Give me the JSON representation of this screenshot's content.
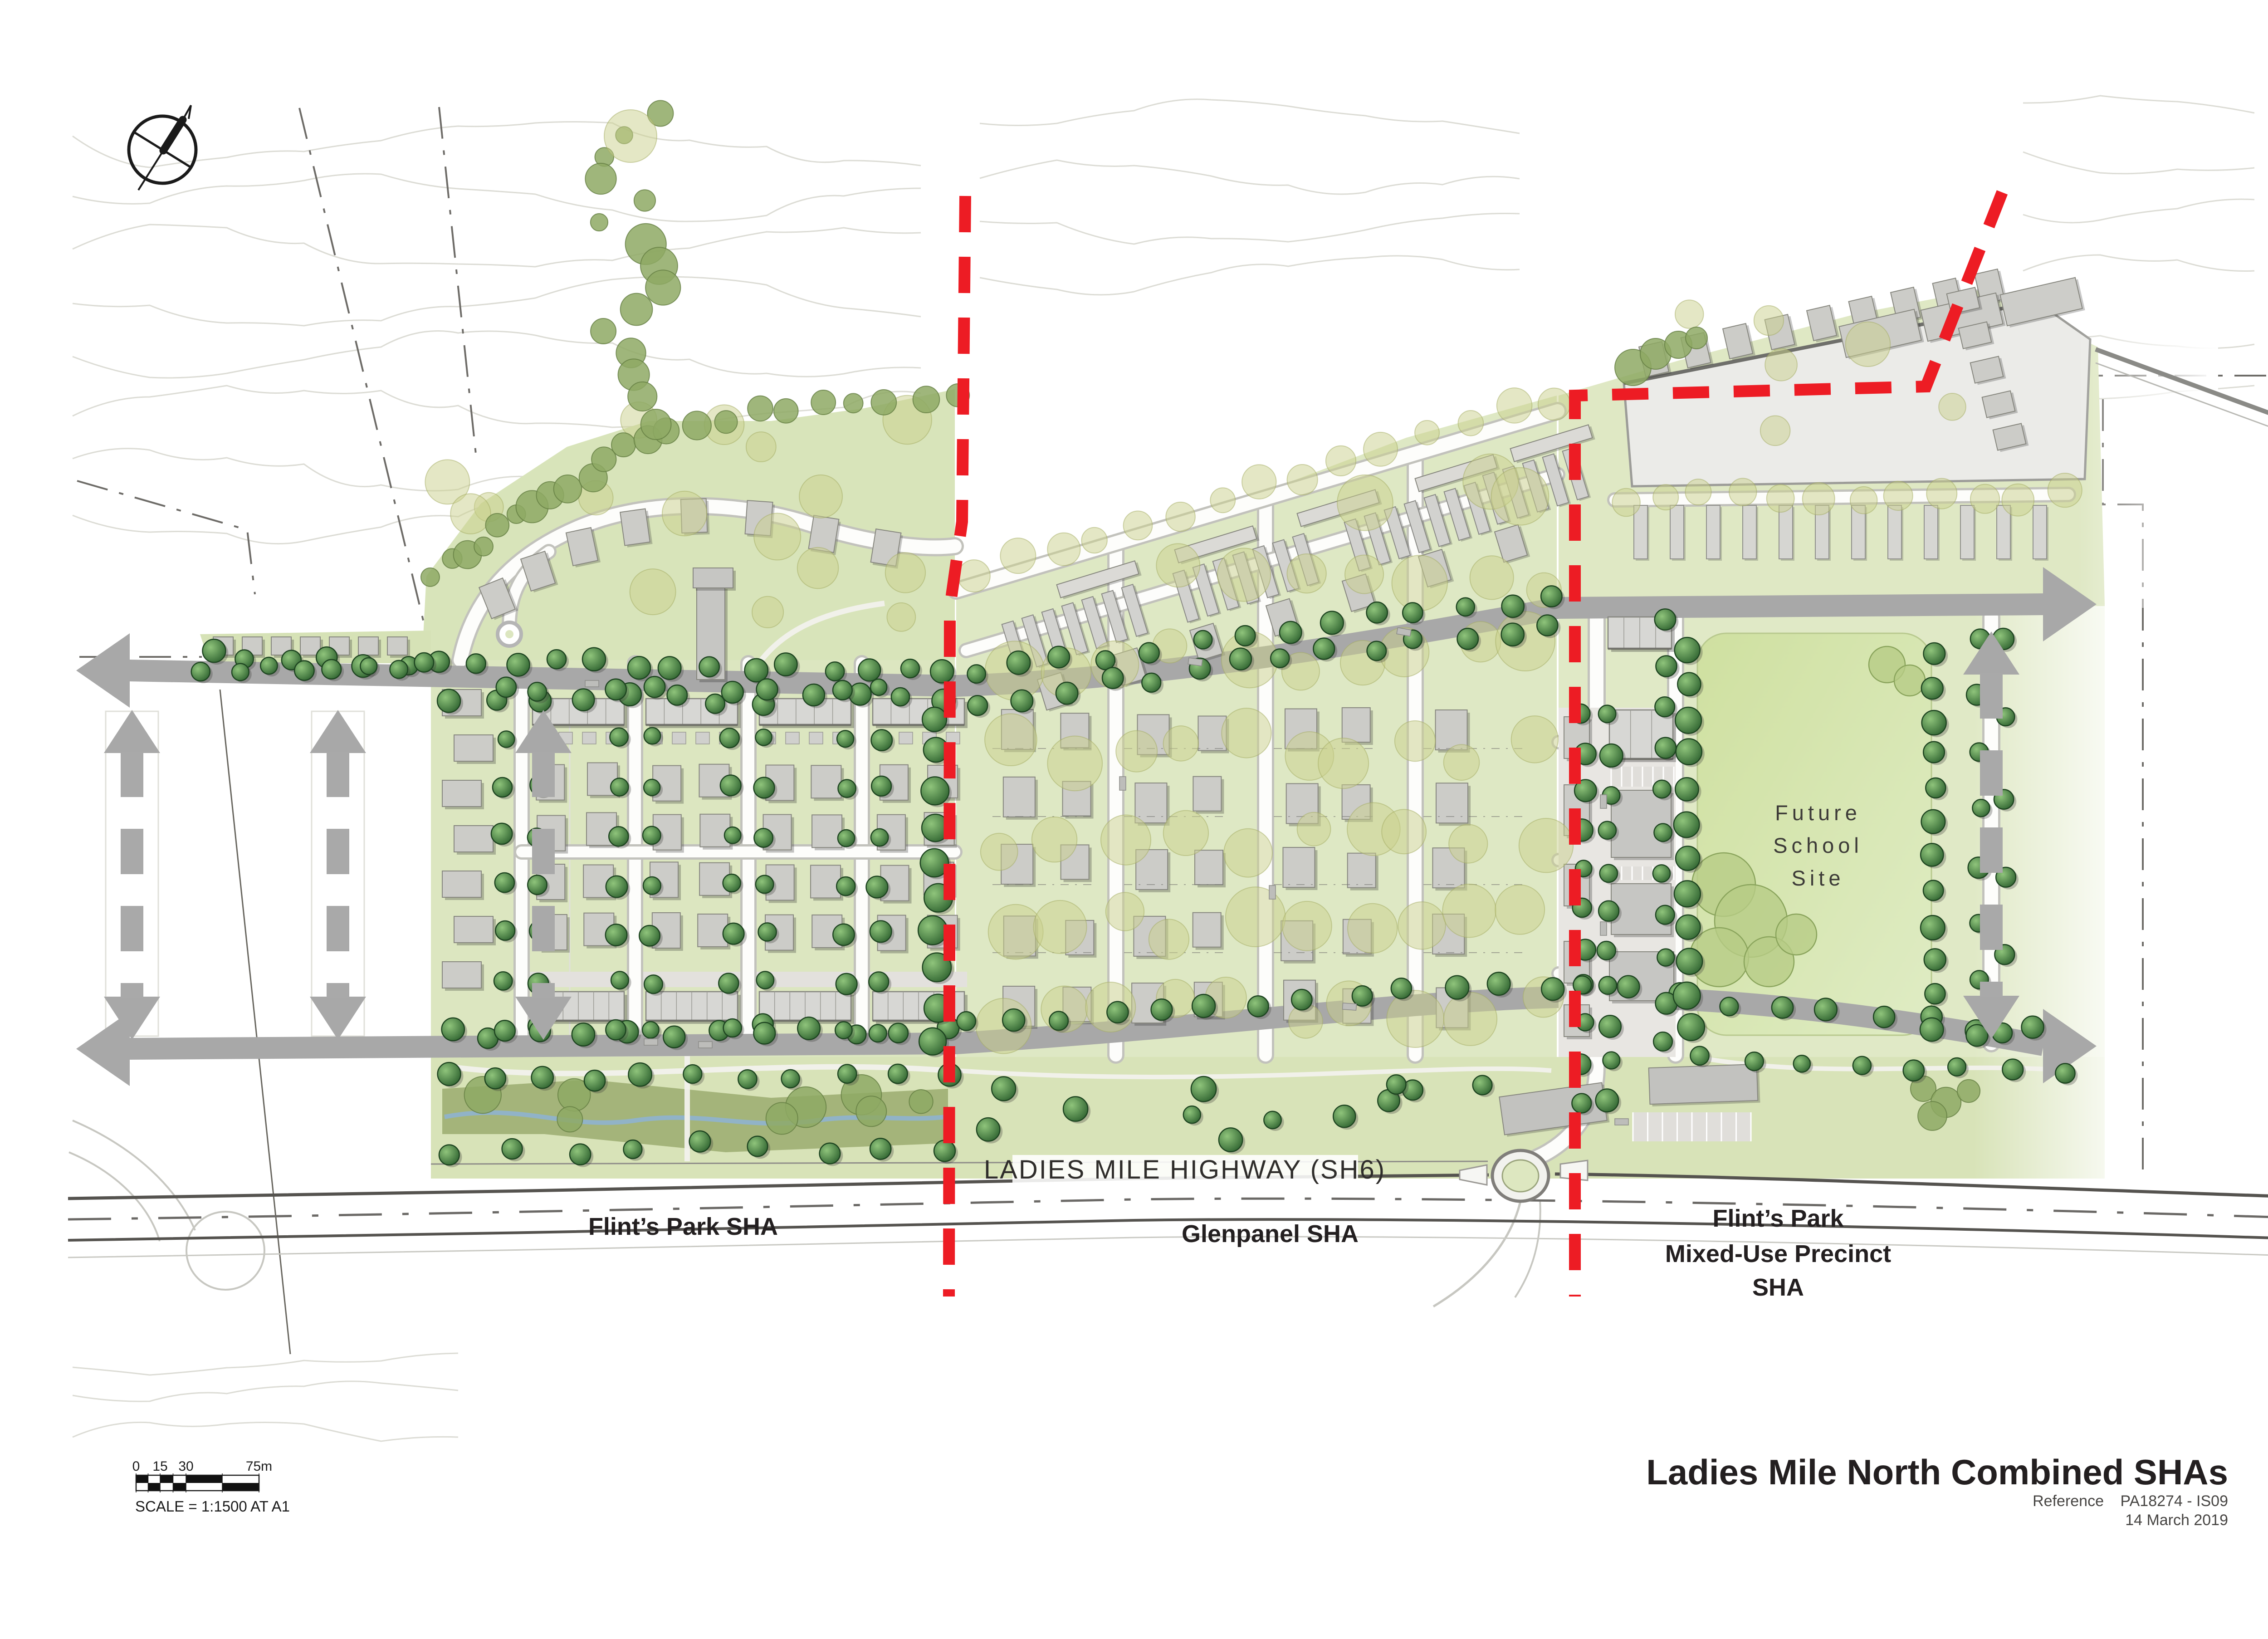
{
  "labels": {
    "highway": "LADIES MILE HIGHWAY (SH6)",
    "zone_flints": "Flint’s Park SHA",
    "zone_glenpanel": "Glenpanel SHA",
    "zone_mixed_1": "Flint’s Park",
    "zone_mixed_2": "Mixed-Use Precinct",
    "zone_mixed_3": "SHA",
    "school_1": "Future",
    "school_2": "School",
    "school_3": "Site"
  },
  "scale_bar": {
    "ticks": [
      "0",
      "15",
      "30",
      "75m"
    ],
    "note": "SCALE = 1:1500 AT A1"
  },
  "title_block": {
    "title": "Ladies Mile North Combined SHAs",
    "reference_label": "Reference",
    "reference_value": "PA18274 - IS09",
    "date": "14 March 2019"
  },
  "colors": {
    "boundary_red": "#ed1c24",
    "road_gray": "#a8a8a8",
    "green_light": "#dde7c2",
    "green_field": "#cfe0a2",
    "tree_dark": "#2d5f2d",
    "ink": "#231f20"
  }
}
